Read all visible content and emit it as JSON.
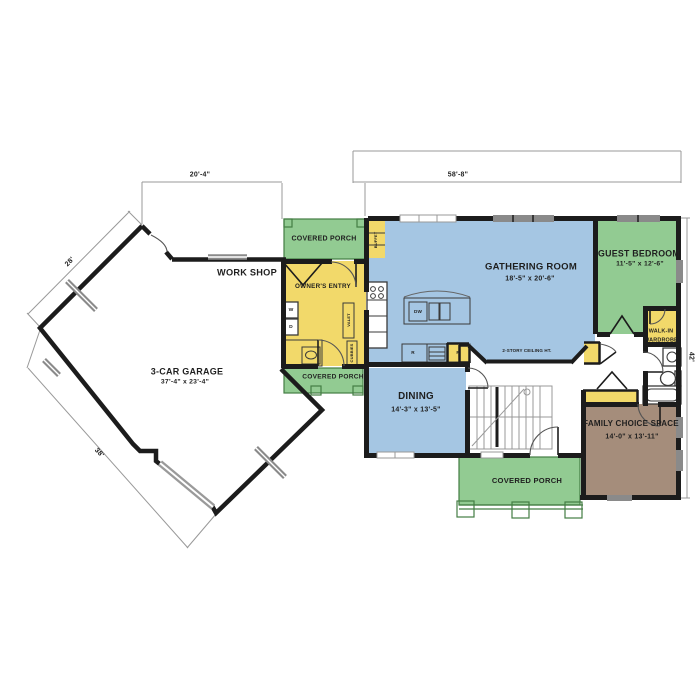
{
  "title": "First floor plan",
  "dimensions": {
    "top_left": "20'-4\"",
    "top_right": "58'-8\"",
    "right": "42'",
    "garage_upper": "28'",
    "garage_lower": "38'"
  },
  "garage": {
    "name": "3-CAR GARAGE",
    "size": "37'-4\" x 23'-4\"",
    "workshop": "WORK SHOP"
  },
  "owners_entry": {
    "name": "OWNER'S ENTRY",
    "washer": "W",
    "dryer": "D",
    "valet": "VALET",
    "cubbies": "CUBBIES"
  },
  "porches": {
    "top": "COVERED PORCH",
    "middle": "COVERED PORCH",
    "bottom": "COVERED PORCH"
  },
  "kitchen": {
    "buffet": "BUFFET",
    "dishwasher": "DW",
    "range": "R",
    "pantry": "P"
  },
  "gathering": {
    "name": "GATHERING ROOM",
    "size": "18'-5\" x 20'-6\"",
    "ceiling": "2-STORY CEILING HT."
  },
  "dining": {
    "name": "DINING",
    "size": "14'-3\" x 13'-5\""
  },
  "guest_bedroom": {
    "name": "GUEST BEDROOM",
    "size": "11'-5\" x 12'-6\""
  },
  "wardrobe": {
    "line1": "WALK-IN",
    "line2": "WARDROBE"
  },
  "family_space": {
    "name": "FAMILY CHOICE SPACE",
    "size": "14'-0\" x 13'-11\""
  },
  "colors": {
    "wall": "#1c1c1c",
    "room-blue": "#a5c6e3",
    "room-green": "#92cb92",
    "room-yellow": "#f2d96a",
    "room-brown": "#a58d7b",
    "window-gray": "#8a8a8a",
    "dim-gray": "#999999"
  }
}
